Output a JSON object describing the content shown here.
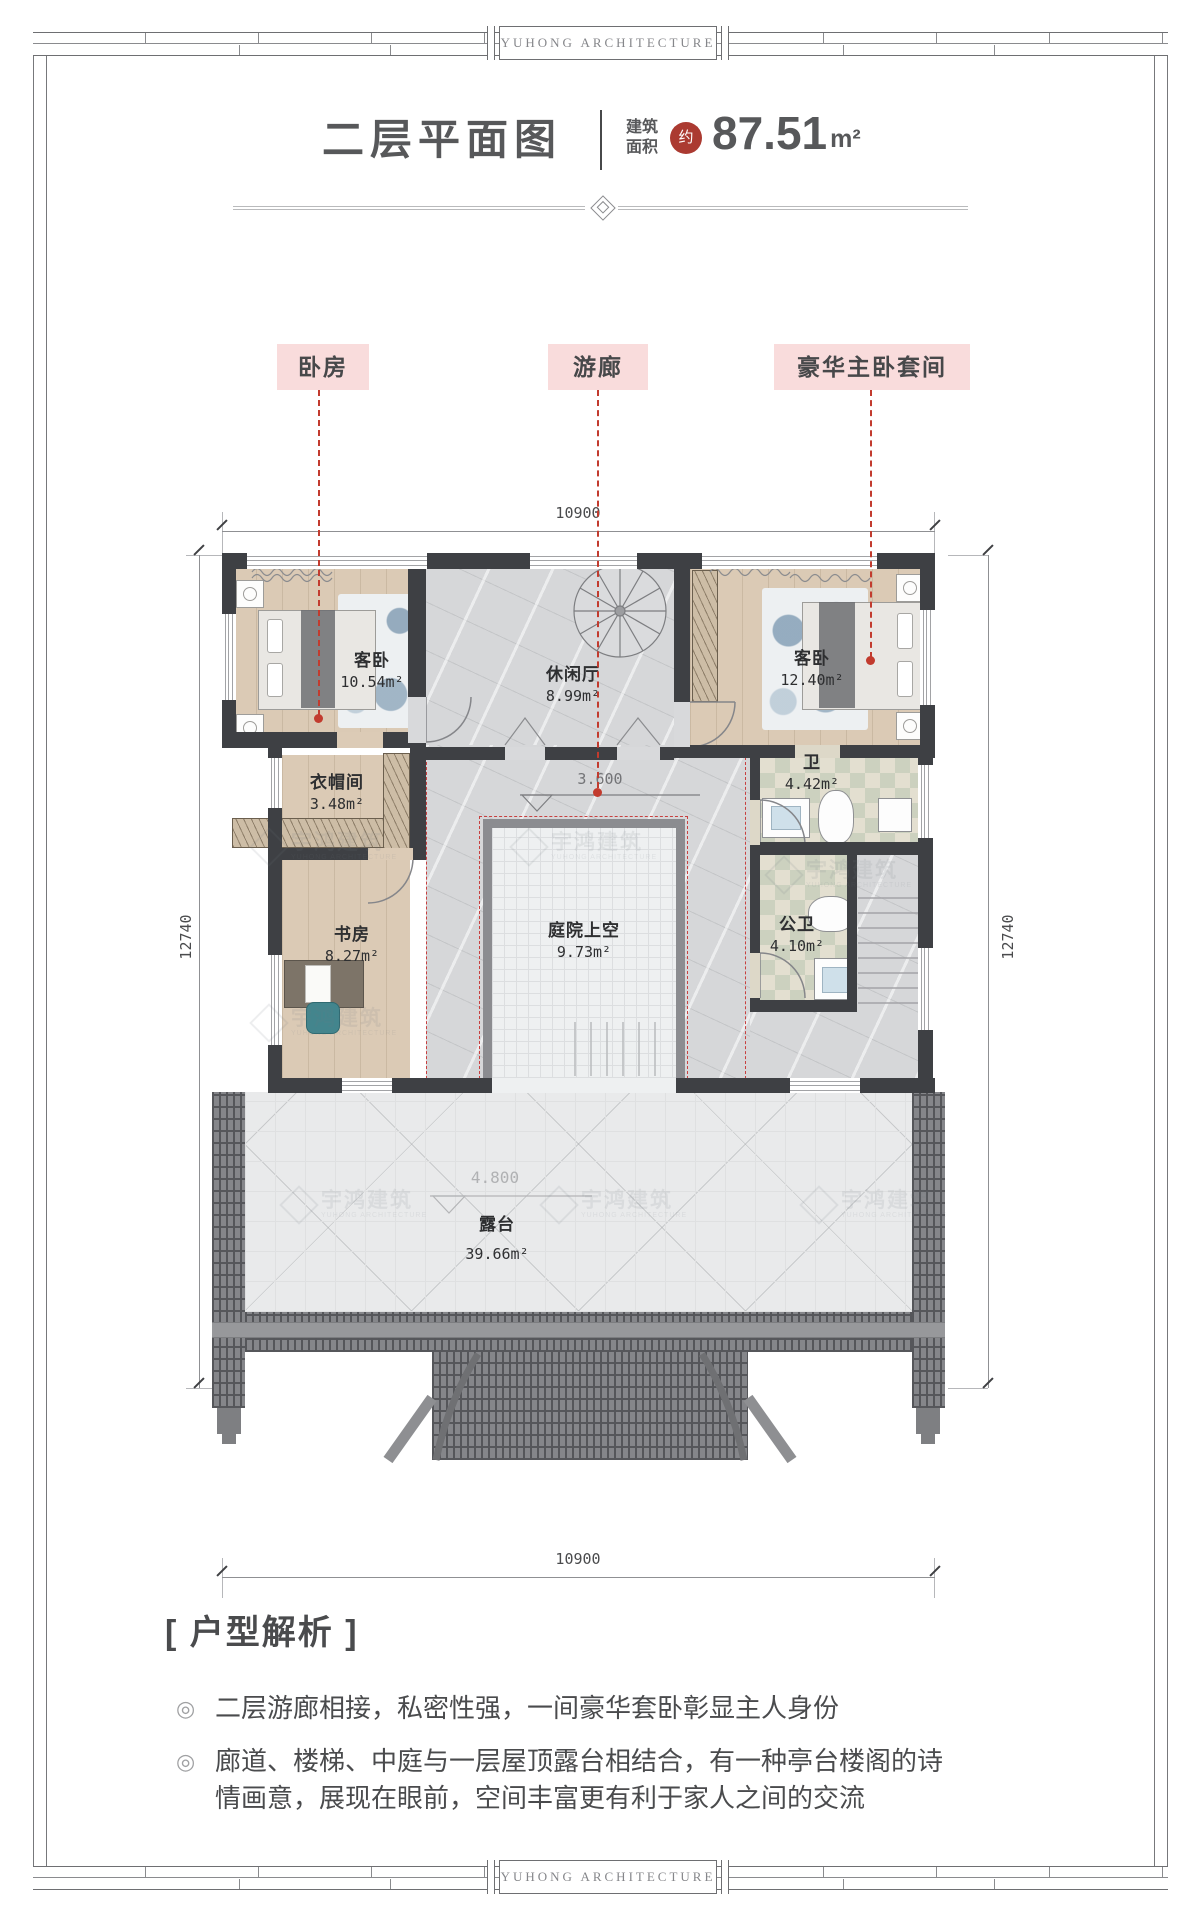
{
  "brand": {
    "name": "YUHONG ARCHITECTURE"
  },
  "title": {
    "text": "二层平面图",
    "area_label": [
      "建筑",
      "面积"
    ],
    "approx_stamp": "约",
    "area_value": "87.51",
    "area_unit": "m²"
  },
  "callouts": [
    {
      "label": "卧房"
    },
    {
      "label": "游廊"
    },
    {
      "label": "豪华主卧套间"
    }
  ],
  "dims": {
    "top": "10900",
    "bottom": "10900",
    "left": "12740",
    "right": "12740"
  },
  "levels": {
    "gallery": "3.600",
    "terrace": "4.800"
  },
  "rooms": {
    "bed1": {
      "name": "客卧",
      "area": "10.54m²"
    },
    "lounge": {
      "name": "休闲厅",
      "area": "8.99m²"
    },
    "bed2": {
      "name": "客卧",
      "area": "12.40m²"
    },
    "cloak": {
      "name": "衣帽间",
      "area": "3.48m²"
    },
    "bath1": {
      "name": "卫",
      "area": "4.42m²"
    },
    "court": {
      "name": "庭院上空",
      "area": "9.73m²"
    },
    "study": {
      "name": "书房",
      "area": "8.27m²"
    },
    "bath2": {
      "name": "公卫",
      "area": "4.10m²"
    },
    "terrace": {
      "name": "露台",
      "area": "39.66m²"
    }
  },
  "analysis": {
    "title": "[ 户型解析 ]",
    "bullet_marker": "◎",
    "bullets": [
      "二层游廊相接，私密性强，一间豪华套卧彰显主人身份",
      "廊道、楼梯、中庭与一层屋顶露台相结合，有一种亭台楼阁的诗情画意，展现在眼前，空间丰富更有利于家人之间的交流"
    ]
  },
  "watermark": {
    "text": "宇鸿建筑",
    "sub": "YUHONG ARCHITECTURE"
  },
  "colors": {
    "accent_red": "#c23b2e",
    "label_pink": "#f9dcdc",
    "wall": "#3e4044",
    "stamp_red": "#ab3a31"
  }
}
